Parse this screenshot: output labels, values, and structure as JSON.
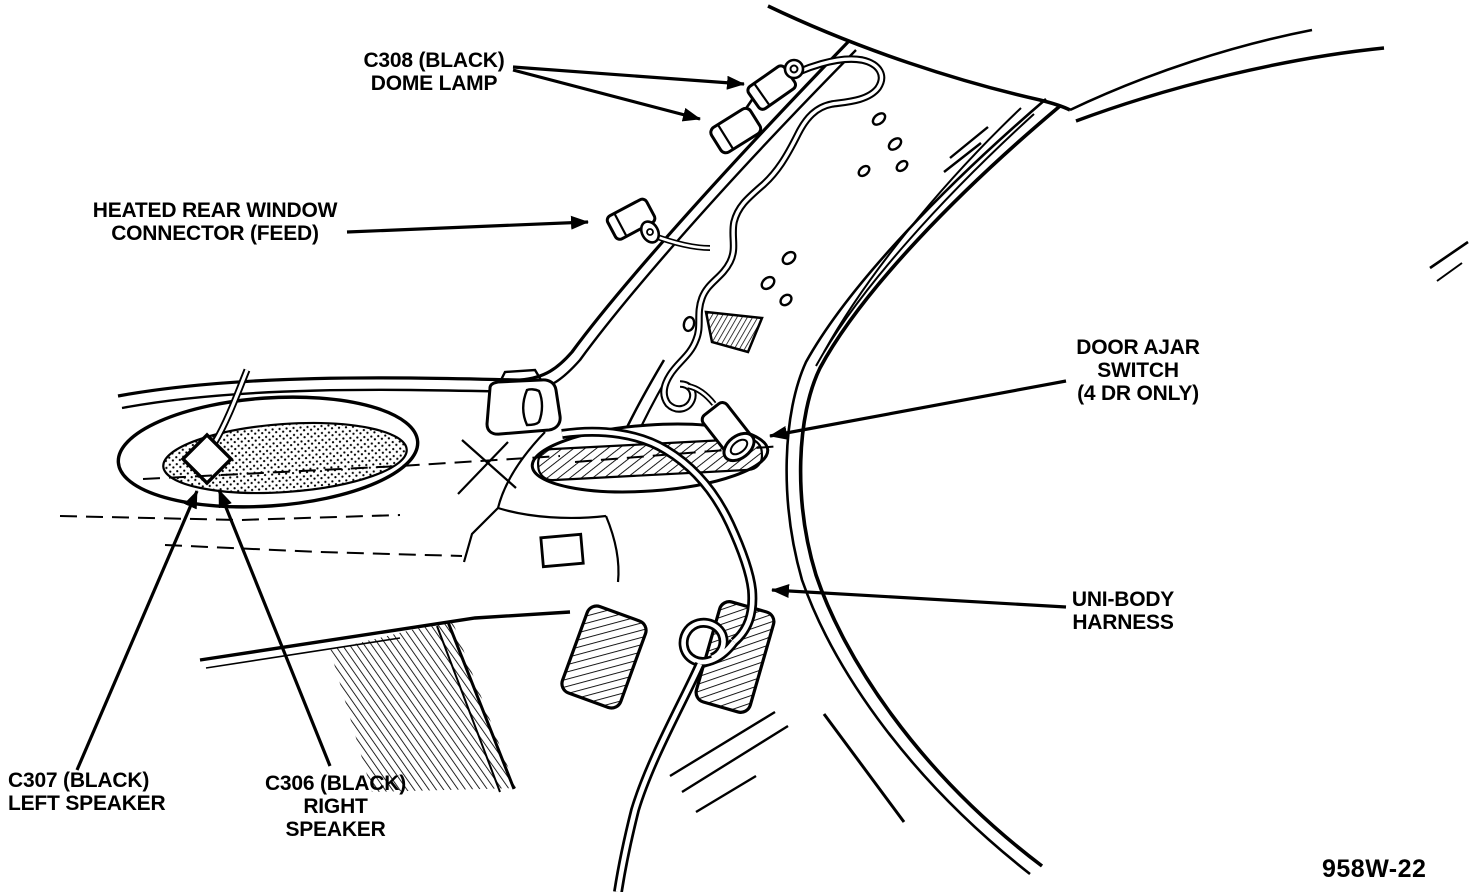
{
  "figure": {
    "number": "958W-22"
  },
  "callouts": {
    "c308": {
      "line1": "C308 (BLACK)",
      "line2": "DOME LAMP"
    },
    "hrw": {
      "line1": "HEATED REAR WINDOW",
      "line2": "CONNECTOR (FEED)"
    },
    "door_ajar": {
      "line1": "DOOR AJAR",
      "line2": "SWITCH",
      "line3": "(4 DR ONLY)"
    },
    "unibody": {
      "line1": "UNI-BODY",
      "line2": "HARNESS"
    },
    "c307": {
      "line1": "C307 (BLACK)",
      "line2": "LEFT SPEAKER"
    },
    "c306": {
      "line1": "C306 (BLACK)",
      "line2": "RIGHT",
      "line3": "SPEAKER"
    }
  },
  "colors": {
    "ink": "#000000",
    "background": "#ffffff"
  }
}
